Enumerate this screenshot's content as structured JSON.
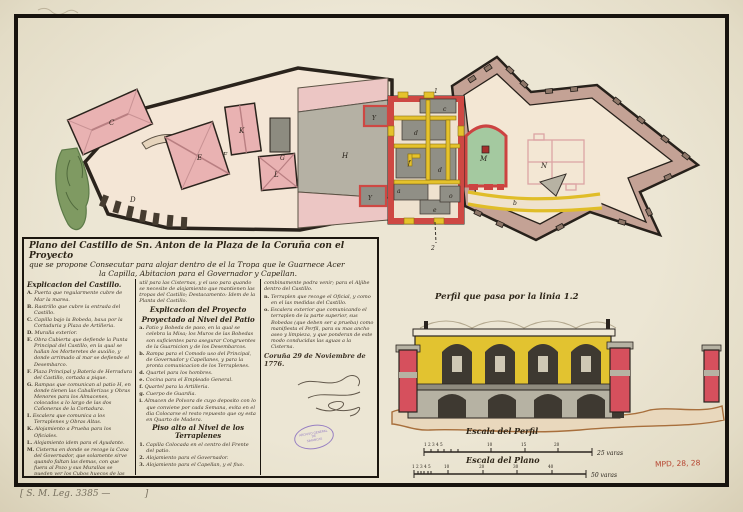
{
  "doc": {
    "title_lines": {
      "l1": "Plano del Castillo de Sn. Anton de la Plaza de la Coruña con el Proyecto",
      "l2": "que se propone Consecutar para alojar dentro de el la Tropa que le Guarnece Acer",
      "l3": "la Capilla, Abitacion para el Governador y Capellan."
    },
    "dateline": "Coruña 29 de Noviembre de 1776.",
    "leg_note": "[ S. M. Leg. 3385 —            ]",
    "mpd_ref": "MPD, 28, 28"
  },
  "castillo": {
    "heading": "Explicacion del Castillo.",
    "items": [
      {
        "key": "A.",
        "text": "Puerta que regularmente cubre de Mar la marea."
      },
      {
        "key": "B.",
        "text": "Rastrillo que cubre la entrada del Castillo."
      },
      {
        "key": "C.",
        "text": "Capilla bajo la Bobeda, baxa por la Cortaduria y Plaza de Artilleria."
      },
      {
        "key": "D.",
        "text": "Muralla exterior."
      },
      {
        "key": "E.",
        "text": "Obra Cubierta que defiende la Punta Principal del Castillo, en la qual se hallan los Morteretes de auxilio, y donde arrimado al mar se defiende el Desembarco."
      },
      {
        "key": "F.",
        "text": "Plaza Principal y Bateria de Herradura del Castillo, cortada a pique."
      },
      {
        "key": "G.",
        "text": "Rampas que comunican al patio H, en donde tienen las Caballerizas y Obras Menores para los Almacenes, colocados a lo largo de las dos Cañoneras de la Cortadura."
      },
      {
        "key": "I.",
        "text": "Escalera que comunica a los Terraplenes y Obras Altas."
      },
      {
        "key": "K.",
        "text": "Alojamiento a Prueba para los Oficiales."
      },
      {
        "key": "L.",
        "text": "Alojamiento idem para el Ayudante."
      },
      {
        "key": "M.",
        "text": "Cisterna en donde se recoge la Cava del Governador, que solamente sirve quando faltan las demas, con que fuera al Pozo y sus Murallas se pueden ver los Cubos huecos de las Cisternas para mantenerse la Guarnicion, y que el puesto no quede sin pasada para el Quartel; de suerte que la Tropa este segura en medio de la Guarnicion."
      },
      {
        "key": "N.",
        "text": "Plaza en donde queda situada la Capilla que se transporta; Cavadas de las quales dividen Calderas que recelan el uso de ella."
      }
    ]
  },
  "proyecto": {
    "intro": "util para las Cisternas, y el uso para quando se necesite de alojamiento que mantienen las tropas del Castillo; Destacamento: Idem de la Planta del Castillo.",
    "heading": "Explicacion del Proyecto",
    "subheading": "Proyectado al Nivel del Patio",
    "items": [
      {
        "key": "a.",
        "text": "Patio y Bobeda de paso, en la qual se celebra la Misa; los Muros de las Bobedas son suficientes para asegurar Congruentes de la Guarnicion y de los Desembarcos."
      },
      {
        "key": "b.",
        "text": "Rampa para el Comodo uso del Principal, de Governador y Capellanes, y para la pronta comunicacion de los Terraplenes."
      },
      {
        "key": "d.",
        "text": "Quartel para los hombres."
      },
      {
        "key": "e.",
        "text": "Cocina para el Empleado General."
      },
      {
        "key": "f.",
        "text": "Quartel para la Artilleria."
      },
      {
        "key": "g.",
        "text": "Cuerpo de Guardia."
      },
      {
        "key": "i.",
        "text": "Almacen de Polvora de cuyo deposito con lo que conviene por cada Semana, evita en el dia Colocarse el resto repuesto que oy esta en Quarto de Madera."
      }
    ],
    "piso": {
      "heading": "Piso alto al Nivel de los Terraplenes",
      "items": [
        {
          "key": "1.",
          "text": "Capilla Colocada en el centro del Frente del patio."
        },
        {
          "key": "2.",
          "text": "Alojamiento para el Governador."
        },
        {
          "key": "3.",
          "text": "Alojamiento para el Capellan, y el fixo."
        }
      ]
    }
  },
  "col3": {
    "intro": "combinamente podra venir; para el Aljibe dentro del Castillo.",
    "items": [
      {
        "key": "n.",
        "text": "Terraplen que recoge el Oficial, y como en el las medidas del Castillo."
      },
      {
        "key": "o.",
        "text": "Escalera exterior que comunicando el terraplen de la parte superior, sus Bobedas (que deben ser a prueba) como manifiesta el Perfil, para su mas ancho aseo y limpieza, y que ponderan de este modo conducidas las aguas a la Cisterna."
      }
    ]
  },
  "stamp": {
    "line1": "ARCHIVO GENERAL",
    "line2": "DE",
    "line3": "SIMANCAS"
  },
  "perfil": {
    "heading": "Perfil que pasa por la linia 1.2"
  },
  "scales": {
    "perfil_label": "Escala del Perfil",
    "perfil_cluster": "1 2 3 4 5",
    "perfil_ticks": [
      "10",
      "15",
      "20"
    ],
    "perfil_end": "25 varas",
    "plano_label": "Escala del Plano",
    "plano_cluster": "1 2 3 4 5",
    "plano_ticks": [
      "10",
      "20",
      "30",
      "40"
    ],
    "plano_end": "50 varas"
  },
  "plan": {
    "labels": {
      "C": "C",
      "E": "E",
      "K": "K",
      "L": "L",
      "D": "D",
      "F": "F",
      "G": "G",
      "H": "H",
      "Y1": "Y",
      "Y2": "Y",
      "a": "a",
      "b": "b",
      "c": "c",
      "d1": "d",
      "d2": "d",
      "e": "e",
      "f": "f",
      "o": "o",
      "M": "M",
      "N": "N",
      "s1": "1",
      "s2": "2"
    }
  }
}
